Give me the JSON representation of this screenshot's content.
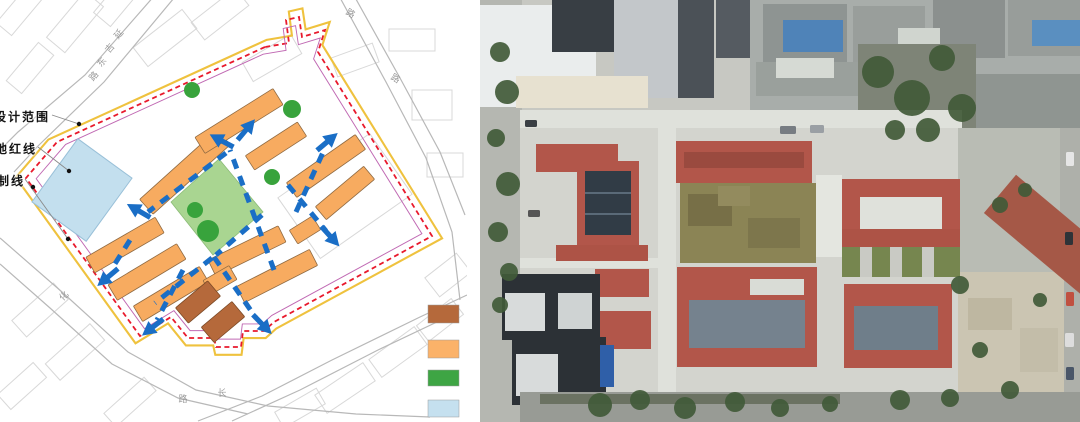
{
  "figure": {
    "description": "two-panel urban design figure: site plan diagram (left) and aerial photograph of the built campus (right)"
  },
  "left_panel": {
    "type": "site-plan-diagram",
    "annotations": [
      {
        "text": "设计范围",
        "left": -6,
        "top": 108,
        "leader": [
          [
            52,
            115
          ],
          [
            79,
            124
          ]
        ],
        "dot": [
          79,
          124
        ]
      },
      {
        "text": "地红线",
        "left": -5,
        "top": 140,
        "leader": [
          [
            38,
            147
          ],
          [
            69,
            171
          ]
        ],
        "dot": [
          69,
          171
        ]
      },
      {
        "text": "制线",
        "left": -3,
        "top": 172,
        "leader": [
          [
            25,
            179
          ],
          [
            68,
            239
          ]
        ],
        "dot": [
          68,
          239
        ]
      }
    ],
    "extra_dots": [
      [
        33,
        187
      ]
    ],
    "road_chars": [
      {
        "ch": "延",
        "x": 121,
        "y": 36,
        "rot": -50
      },
      {
        "ch": "吉",
        "x": 112,
        "y": 50,
        "rot": -50
      },
      {
        "ch": "东",
        "x": 104,
        "y": 64,
        "rot": -50
      },
      {
        "ch": "路",
        "x": 96,
        "y": 78,
        "rot": -50
      },
      {
        "ch": "路",
        "x": 349,
        "y": 16,
        "rot": 30
      },
      {
        "ch": "路",
        "x": 394,
        "y": 81,
        "rot": 30
      },
      {
        "ch": "化",
        "x": 66,
        "y": 298,
        "rot": -45
      },
      {
        "ch": "路",
        "x": 183,
        "y": 402,
        "rot": 0
      },
      {
        "ch": "长",
        "x": 222,
        "y": 396,
        "rot": 0
      }
    ],
    "legend": [
      {
        "name": "brown-swatch",
        "color": "#b5693b",
        "y": 305,
        "h": 18
      },
      {
        "name": "orange-swatch",
        "color": "#fbb269",
        "y": 340,
        "h": 18
      },
      {
        "name": "green-swatch",
        "color": "#3ea544",
        "y": 370,
        "h": 16
      },
      {
        "name": "light-blue-swatch",
        "color": "#c5e0ef",
        "y": 400,
        "h": 17
      }
    ],
    "colors": {
      "boundary_red": "#e8192c",
      "boundary_yellow": "#efc23e",
      "boundary_magenta": "#c069b3",
      "circulation_blue": "#1a6ec6",
      "orange_building": "#f7ab60",
      "brown_building": "#b5693b",
      "courtyard_green": "#a9d591",
      "tree_green": "#38a33c",
      "playground_blue": "#c3dfee",
      "road_gray": "#b8b8b8",
      "faint_block": "#d8d8d8"
    },
    "boundary": [
      [
        265,
        47
      ],
      [
        57,
        142
      ],
      [
        26,
        178
      ],
      [
        140,
        336
      ],
      [
        171,
        317
      ],
      [
        188,
        338
      ],
      [
        214,
        338
      ],
      [
        216,
        347
      ],
      [
        241,
        347
      ],
      [
        243,
        331
      ],
      [
        264,
        331
      ],
      [
        274,
        322
      ],
      [
        432,
        236
      ],
      [
        318,
        52
      ],
      [
        325,
        30
      ],
      [
        302,
        37
      ],
      [
        299,
        17
      ],
      [
        286,
        20
      ],
      [
        289,
        43
      ]
    ],
    "playground": {
      "cx": 82,
      "cy": 190,
      "w": 67,
      "h": 78,
      "rot": 36
    },
    "courtyard": [
      [
        219,
        159
      ],
      [
        263,
        212
      ],
      [
        213,
        255
      ],
      [
        171,
        202
      ]
    ],
    "trees": [
      [
        192,
        90,
        8
      ],
      [
        292,
        109,
        9
      ],
      [
        272,
        177,
        8
      ],
      [
        195,
        210,
        8
      ],
      [
        208,
        231,
        11
      ]
    ],
    "orange_buildings": [
      [
        185,
        172,
        104,
        20,
        -42
      ],
      [
        239,
        121,
        92,
        19,
        -32
      ],
      [
        276,
        146,
        62,
        17,
        -33
      ],
      [
        326,
        166,
        84,
        18,
        -35
      ],
      [
        345,
        193,
        63,
        17,
        -40
      ],
      [
        305,
        230,
        27,
        16,
        -32
      ],
      [
        125,
        245,
        80,
        18,
        -30
      ],
      [
        147,
        272,
        80,
        18,
        -31
      ],
      [
        171,
        294,
        77,
        18,
        -31
      ],
      [
        247,
        251,
        78,
        18,
        -26
      ],
      [
        277,
        276,
        82,
        18,
        -27
      ],
      [
        220,
        280,
        30,
        16,
        -30
      ]
    ],
    "brown_buildings": [
      [
        198,
        302,
        42,
        20,
        -40
      ],
      [
        223,
        322,
        40,
        20,
        -40
      ]
    ],
    "paths": [
      [
        [
          274,
          270
        ],
        [
          230,
          150
        ]
      ],
      [
        [
          226,
          153
        ],
        [
          148,
          212
        ]
      ],
      [
        [
          212,
          258
        ],
        [
          155,
          303
        ]
      ],
      [
        [
          214,
          257
        ],
        [
          256,
          318
        ]
      ],
      [
        [
          296,
          212
        ],
        [
          325,
          148
        ]
      ],
      [
        [
          288,
          185
        ],
        [
          326,
          231
        ]
      ],
      [
        [
          130,
          240
        ],
        [
          111,
          270
        ]
      ],
      [
        [
          183,
          270
        ],
        [
          157,
          320
        ]
      ],
      [
        [
          262,
          215
        ],
        [
          216,
          255
        ]
      ]
    ],
    "arrows": [
      [
        246,
        130,
        -50
      ],
      [
        222,
        141,
        -152
      ],
      [
        327,
        142,
        -40
      ],
      [
        330,
        236,
        48
      ],
      [
        139,
        211,
        -150
      ],
      [
        108,
        277,
        140
      ],
      [
        153,
        327,
        142
      ],
      [
        262,
        324,
        46
      ]
    ],
    "roads": [
      [
        [
          155,
          -5
        ],
        [
          85,
          75
        ],
        [
          18,
          132
        ],
        [
          0,
          150
        ]
      ],
      [
        [
          174,
          -2
        ],
        [
          104,
          82
        ],
        [
          38,
          146
        ],
        [
          14,
          172
        ]
      ],
      [
        [
          338,
          -6
        ],
        [
          386,
          82
        ],
        [
          426,
          158
        ],
        [
          452,
          232
        ],
        [
          460,
          300
        ]
      ],
      [
        [
          352,
          -8
        ],
        [
          400,
          78
        ],
        [
          440,
          152
        ],
        [
          465,
          215
        ]
      ],
      [
        [
          0,
          238
        ],
        [
          62,
          292
        ],
        [
          128,
          352
        ],
        [
          196,
          390
        ],
        [
          268,
          406
        ],
        [
          356,
          414
        ],
        [
          430,
          417
        ]
      ],
      [
        [
          0,
          264
        ],
        [
          50,
          308
        ],
        [
          112,
          364
        ],
        [
          178,
          398
        ],
        [
          248,
          414
        ]
      ],
      [
        [
          198,
          421
        ],
        [
          262,
          396
        ],
        [
          332,
          360
        ],
        [
          420,
          317
        ],
        [
          467,
          295
        ]
      ],
      [
        [
          232,
          421
        ],
        [
          300,
          390
        ],
        [
          378,
          350
        ],
        [
          458,
          312
        ]
      ]
    ],
    "faint_blocks": [
      [
        20,
        10,
        50,
        20,
        -50
      ],
      [
        75,
        22,
        60,
        24,
        -50
      ],
      [
        120,
        -2,
        56,
        22,
        -50
      ],
      [
        30,
        68,
        50,
        20,
        -50
      ],
      [
        165,
        38,
        62,
        24,
        -38
      ],
      [
        220,
        14,
        56,
        22,
        -38
      ],
      [
        272,
        58,
        56,
        22,
        -30
      ],
      [
        355,
        60,
        44,
        20,
        -20
      ],
      [
        412,
        40,
        46,
        22,
        0
      ],
      [
        432,
        105,
        40,
        30,
        0
      ],
      [
        445,
        165,
        36,
        24,
        0
      ],
      [
        448,
        275,
        40,
        24,
        -38
      ],
      [
        40,
        310,
        56,
        22,
        -42
      ],
      [
        75,
        352,
        60,
        22,
        -42
      ],
      [
        22,
        386,
        48,
        20,
        -42
      ],
      [
        130,
        402,
        54,
        18,
        -42
      ],
      [
        300,
        408,
        48,
        18,
        -30
      ],
      [
        345,
        388,
        58,
        22,
        -34
      ],
      [
        398,
        352,
        56,
        22,
        -36
      ],
      [
        440,
        320,
        44,
        20,
        -38
      ],
      [
        345,
        196,
        112,
        74,
        -35
      ]
    ]
  },
  "right_panel": {
    "type": "aerial-photograph",
    "background": "#c7c8c2",
    "blocks": [
      [
        0,
        0,
        42,
        422,
        "#b5b7b1"
      ],
      [
        0,
        5,
        116,
        102,
        "#eaeded"
      ],
      [
        72,
        0,
        64,
        52,
        "#383e44"
      ],
      [
        134,
        0,
        64,
        98,
        "#c3c7ca"
      ],
      [
        198,
        0,
        36,
        98,
        "#4b5157"
      ],
      [
        236,
        0,
        34,
        58,
        "#555b61"
      ],
      [
        36,
        76,
        132,
        32,
        "#e7e1d0"
      ],
      [
        270,
        0,
        330,
        132,
        "#a8adaa"
      ],
      [
        283,
        4,
        84,
        58,
        "#8e9492"
      ],
      [
        303,
        20,
        60,
        32,
        "#4f83b8"
      ],
      [
        373,
        6,
        72,
        64,
        "#999e9b"
      ],
      [
        453,
        0,
        72,
        58,
        "#8b908e"
      ],
      [
        528,
        0,
        72,
        56,
        "#989d9a"
      ],
      [
        552,
        20,
        48,
        26,
        "#5a8fc0"
      ],
      [
        276,
        62,
        104,
        34,
        "#9aa09c"
      ],
      [
        486,
        74,
        114,
        54,
        "#8f9591"
      ],
      [
        296,
        58,
        58,
        20,
        "#d6dad4"
      ],
      [
        418,
        28,
        42,
        26,
        "#d0d5cf"
      ],
      [
        378,
        44,
        118,
        92,
        "#7e8477"
      ],
      [
        40,
        110,
        442,
        18,
        "#dfe1db"
      ],
      [
        40,
        128,
        442,
        264,
        "#d3d4ce"
      ],
      [
        178,
        128,
        18,
        264,
        "#dfe1db"
      ],
      [
        40,
        258,
        142,
        10,
        "#dfe1db"
      ],
      [
        478,
        128,
        102,
        146,
        "#b9bcb4"
      ],
      [
        580,
        128,
        20,
        294,
        "#aeb0aa"
      ],
      [
        478,
        272,
        106,
        128,
        "#cbc5b2"
      ],
      [
        488,
        298,
        44,
        32,
        "#beb7a1"
      ],
      [
        540,
        328,
        38,
        44,
        "#c3bda9"
      ],
      [
        200,
        183,
        136,
        80,
        "#8b8455"
      ],
      [
        208,
        194,
        44,
        32,
        "#776f47"
      ],
      [
        268,
        218,
        52,
        30,
        "#7d764c"
      ],
      [
        238,
        186,
        32,
        20,
        "#938b5e"
      ],
      [
        196,
        141,
        136,
        42,
        "#b2564a"
      ],
      [
        204,
        152,
        120,
        16,
        "#9a4a3f"
      ],
      [
        56,
        144,
        82,
        28,
        "#b2564a"
      ],
      [
        97,
        161,
        62,
        86,
        "#b2564a"
      ],
      [
        105,
        171,
        46,
        64,
        "#313c46"
      ],
      [
        105,
        192,
        46,
        2,
        "#5a6a78"
      ],
      [
        105,
        213,
        46,
        2,
        "#5a6a78"
      ],
      [
        76,
        245,
        92,
        16,
        "#ad5346"
      ],
      [
        115,
        269,
        54,
        28,
        "#b2564a"
      ],
      [
        115,
        311,
        56,
        38,
        "#b2564a"
      ],
      [
        22,
        274,
        98,
        66,
        "#2c3136"
      ],
      [
        25,
        293,
        40,
        38,
        "#d8dbdb"
      ],
      [
        78,
        293,
        34,
        36,
        "#cfd3d3"
      ],
      [
        32,
        337,
        94,
        68,
        "#2c3136"
      ],
      [
        36,
        354,
        42,
        42,
        "#d8dbdb"
      ],
      [
        120,
        345,
        14,
        42,
        "#2f5fa8"
      ],
      [
        197,
        267,
        140,
        100,
        "#b2564a"
      ],
      [
        209,
        300,
        116,
        48,
        "#75828e"
      ],
      [
        270,
        279,
        54,
        16,
        "#d9dcd6"
      ],
      [
        336,
        175,
        26,
        82,
        "#e4e6e0"
      ],
      [
        362,
        179,
        118,
        70,
        "#b2564a"
      ],
      [
        380,
        197,
        82,
        40,
        "#dfe1db"
      ],
      [
        362,
        229,
        118,
        18,
        "#ad5346"
      ],
      [
        362,
        247,
        118,
        30,
        "#76864f"
      ],
      [
        380,
        247,
        12,
        30,
        "#c9cac4"
      ],
      [
        410,
        247,
        12,
        30,
        "#c9cac4"
      ],
      [
        442,
        247,
        12,
        30,
        "#c9cac4"
      ],
      [
        364,
        284,
        108,
        84,
        "#b2564a"
      ],
      [
        374,
        306,
        84,
        44,
        "#6f7e8a"
      ],
      [
        505,
        210,
        128,
        50,
        "#a55847",
        40
      ],
      [
        40,
        392,
        560,
        30,
        "#989b95"
      ],
      [
        60,
        394,
        300,
        10,
        "#6b7262"
      ]
    ],
    "trees": [
      [
        20,
        52,
        10
      ],
      [
        27,
        92,
        12
      ],
      [
        16,
        138,
        9
      ],
      [
        28,
        184,
        12
      ],
      [
        18,
        232,
        10
      ],
      [
        29,
        272,
        9
      ],
      [
        20,
        305,
        8
      ],
      [
        398,
        72,
        16
      ],
      [
        432,
        98,
        18
      ],
      [
        462,
        58,
        13
      ],
      [
        482,
        108,
        14
      ],
      [
        448,
        130,
        12
      ],
      [
        415,
        130,
        10
      ],
      [
        480,
        285,
        9
      ],
      [
        500,
        350,
        8
      ],
      [
        530,
        390,
        9
      ],
      [
        560,
        300,
        7
      ],
      [
        520,
        205,
        8
      ],
      [
        545,
        190,
        7
      ],
      [
        120,
        405,
        12
      ],
      [
        160,
        400,
        10
      ],
      [
        205,
        408,
        11
      ],
      [
        255,
        402,
        10
      ],
      [
        300,
        408,
        9
      ],
      [
        350,
        404,
        8
      ],
      [
        420,
        400,
        10
      ],
      [
        470,
        398,
        9
      ]
    ],
    "cars": [
      [
        586,
        152,
        8,
        14,
        "#e6e6e6"
      ],
      [
        585,
        232,
        8,
        13,
        "#2e3338"
      ],
      [
        586,
        292,
        8,
        14,
        "#c05040"
      ],
      [
        585,
        333,
        9,
        14,
        "#dddddd"
      ],
      [
        586,
        367,
        8,
        13,
        "#4a5668"
      ],
      [
        45,
        120,
        12,
        7,
        "#3a3f44"
      ],
      [
        48,
        210,
        12,
        7,
        "#555555"
      ],
      [
        300,
        126,
        16,
        8,
        "#777c82"
      ],
      [
        330,
        125,
        14,
        8,
        "#9a9fa4"
      ]
    ]
  }
}
